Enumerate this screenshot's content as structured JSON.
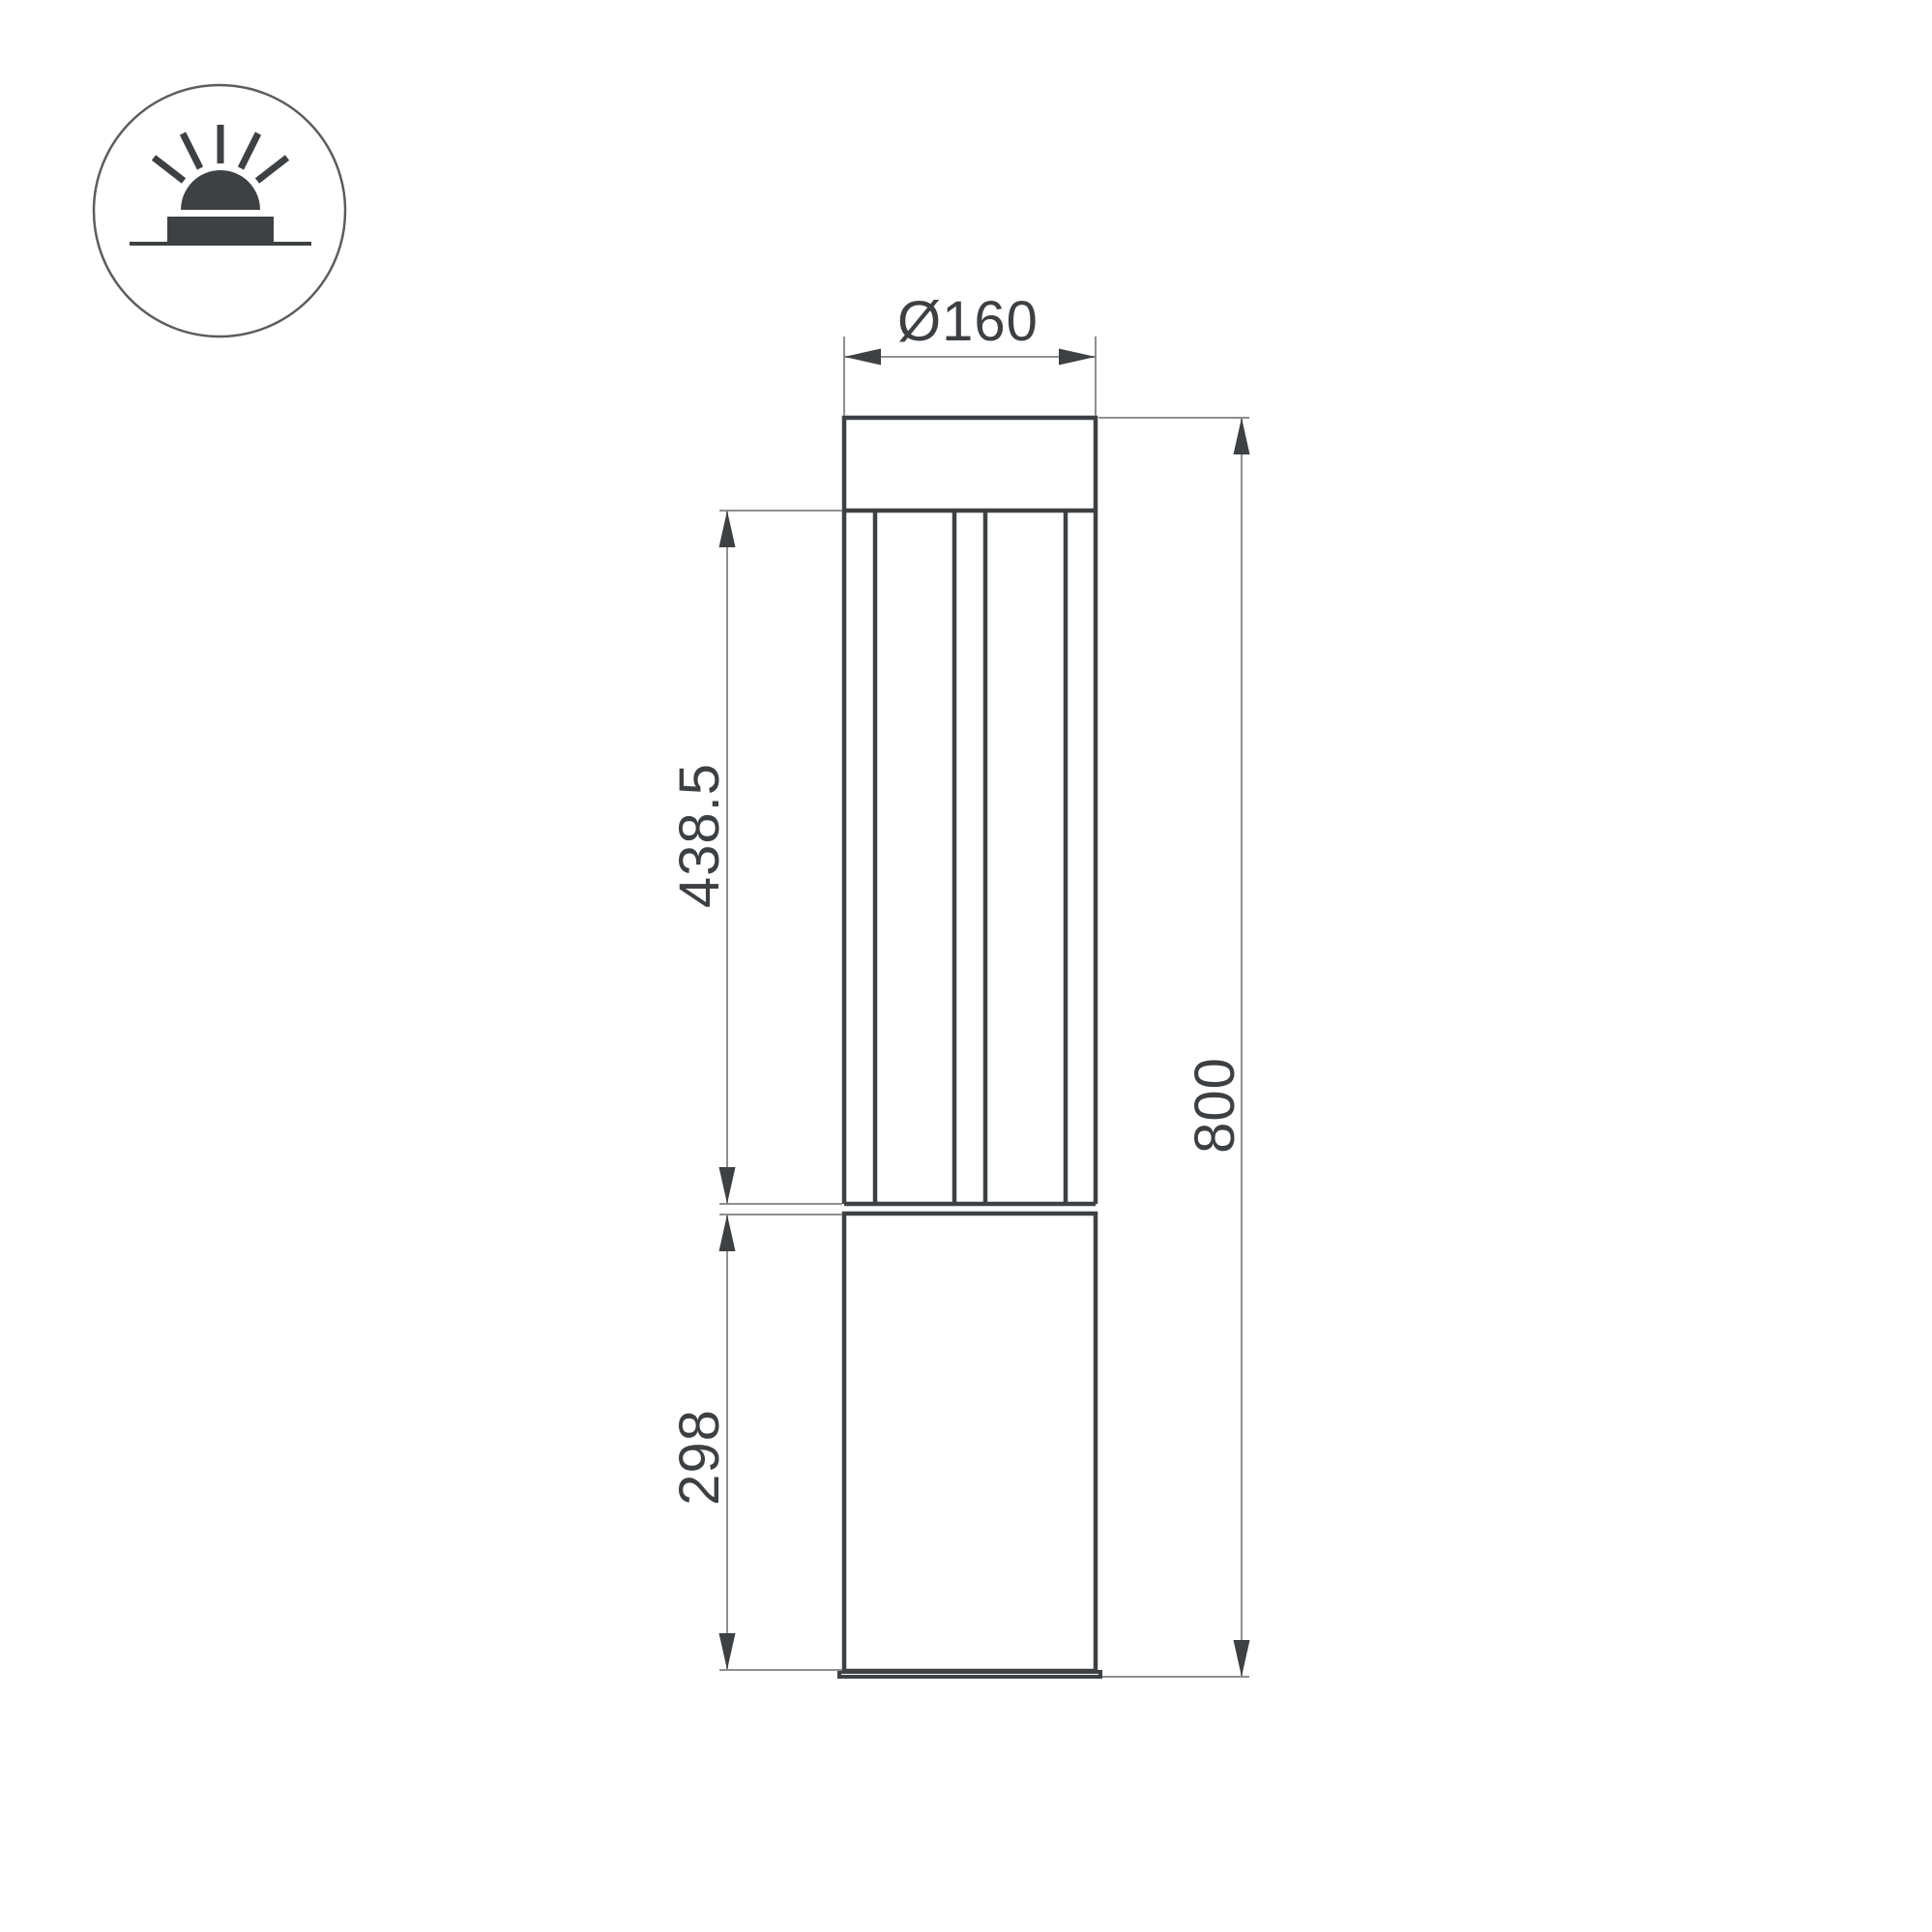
{
  "page": {
    "background": "#ffffff",
    "description": "Technical dimension drawing of a cylindrical bollard ground light, front elevation"
  },
  "icon": {
    "name": "surface-mounted-ground-luminaire-icon",
    "symbol": "dome light on ground line with five light rays inside a circle"
  },
  "dimensions": {
    "diameter_label": "Ø160",
    "lamp_section_height_label": "438.5",
    "base_height_label": "298",
    "total_height_label": "800"
  },
  "colors": {
    "outline": "#3e4144",
    "dimension_line": "#8f8f8f",
    "text": "#3d4043"
  }
}
